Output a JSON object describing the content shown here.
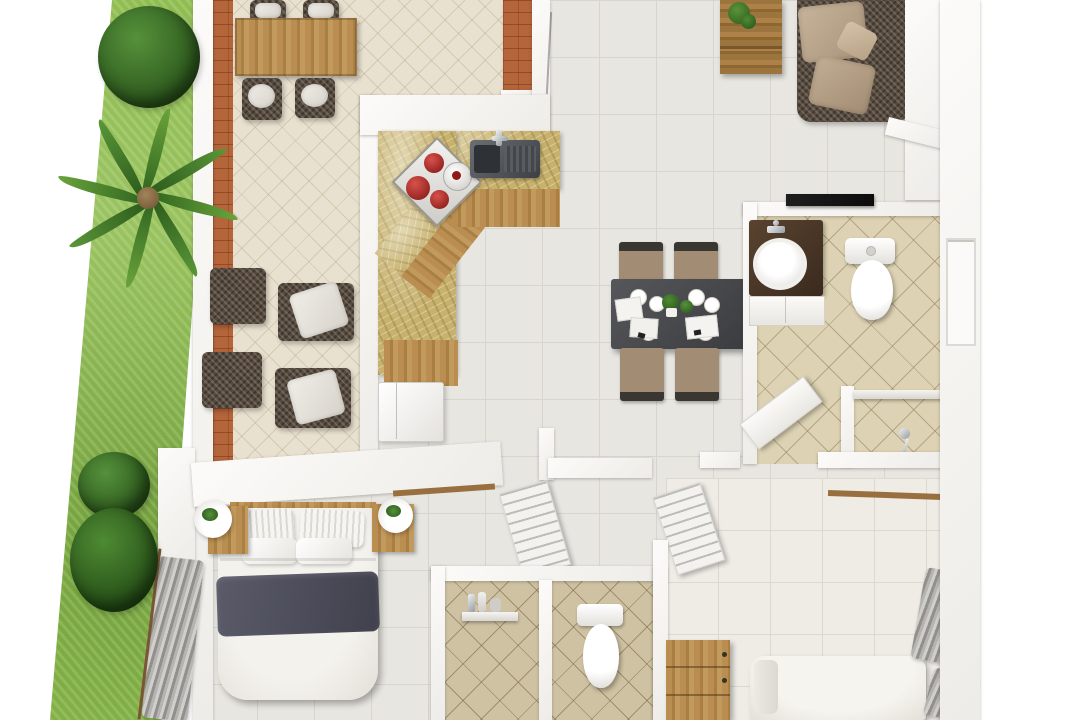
{
  "scene": {
    "type": "3d-floor-plan-top-view",
    "description": "Top-down 3D architectural render of a two-bedroom apartment with a garden strip on the left",
    "rooms": [
      {
        "name": "garden-strip",
        "objects": [
          "lawn",
          "round-bush",
          "palm-tree",
          "shrub",
          "shrub"
        ]
      },
      {
        "name": "patio-terrace",
        "objects": [
          "outdoor-dining-table",
          "dining-chair",
          "dining-chair",
          "dining-chair",
          "dining-chair",
          "lounge-chair",
          "lounge-chair",
          "ottoman",
          "ottoman",
          "terracotta-border",
          "brick-planter"
        ]
      },
      {
        "name": "kitchen",
        "objects": [
          "l-shaped-marble-counter",
          "cooktop-with-red-pots",
          "stock-pot",
          "double-sink-with-faucet",
          "refrigerator",
          "wood-cabinet-fronts"
        ]
      },
      {
        "name": "living-room",
        "objects": [
          "rattan-corner-sofa",
          "tan-cushions",
          "tv-console",
          "console-plant"
        ]
      },
      {
        "name": "dining-area",
        "objects": [
          "dark-dining-table",
          "upholstered-chair",
          "upholstered-chair",
          "upholstered-chair",
          "upholstered-chair",
          "plates",
          "napkins",
          "table-plants"
        ]
      },
      {
        "name": "bathroom-main",
        "objects": [
          "vanity-dark-counter",
          "round-sink",
          "faucet",
          "toilet",
          "shower-area",
          "shower-shelf",
          "hand-shower",
          "door-panel",
          "dark-wall-counter"
        ]
      },
      {
        "name": "hallway",
        "objects": [
          "louvered-door",
          "louvered-door"
        ]
      },
      {
        "name": "bedroom-master",
        "objects": [
          "double-bed",
          "navy-blanket",
          "pillows",
          "wood-headboard",
          "nightstand",
          "nightstand",
          "sphere-lamp",
          "sphere-lamp",
          "glass-door-blinds",
          "curtain-rod"
        ]
      },
      {
        "name": "bathroom-second",
        "objects": [
          "shower-shelf-with-bottles",
          "toilet",
          "divider-wall"
        ]
      },
      {
        "name": "bedroom-second",
        "objects": [
          "bed",
          "pillow",
          "wood-dresser",
          "window-curtains",
          "curtain-rod",
          "window-frame"
        ]
      }
    ],
    "palette": {
      "wall": "#f8f7f4",
      "floor_tile": "#e8e6e1",
      "floor_tile_light": "#efece6",
      "patio_tile": "#e9e1d0",
      "bath_tile": "#ddd2b3",
      "bath_tile_dark": "#cfc2a3",
      "marble_counter": "#c7b16d",
      "wood": "#b98e50",
      "terracotta": "#b4653a",
      "grass": "#8cbb4a",
      "foliage": "#2f641f",
      "sofa_wicker": "#564a3e",
      "sofa_cushion": "#bda88f",
      "dining_table_top": "#4a4b4d",
      "chair_upholstery": "#a28d74",
      "navy_blanket": "#4c4c59",
      "dark_counter": "#141414",
      "vanity_counter": "#4a3628",
      "red_pot": "#a3221e",
      "chrome": "#9aa0a4",
      "curtain_gray": "#92908c"
    }
  }
}
